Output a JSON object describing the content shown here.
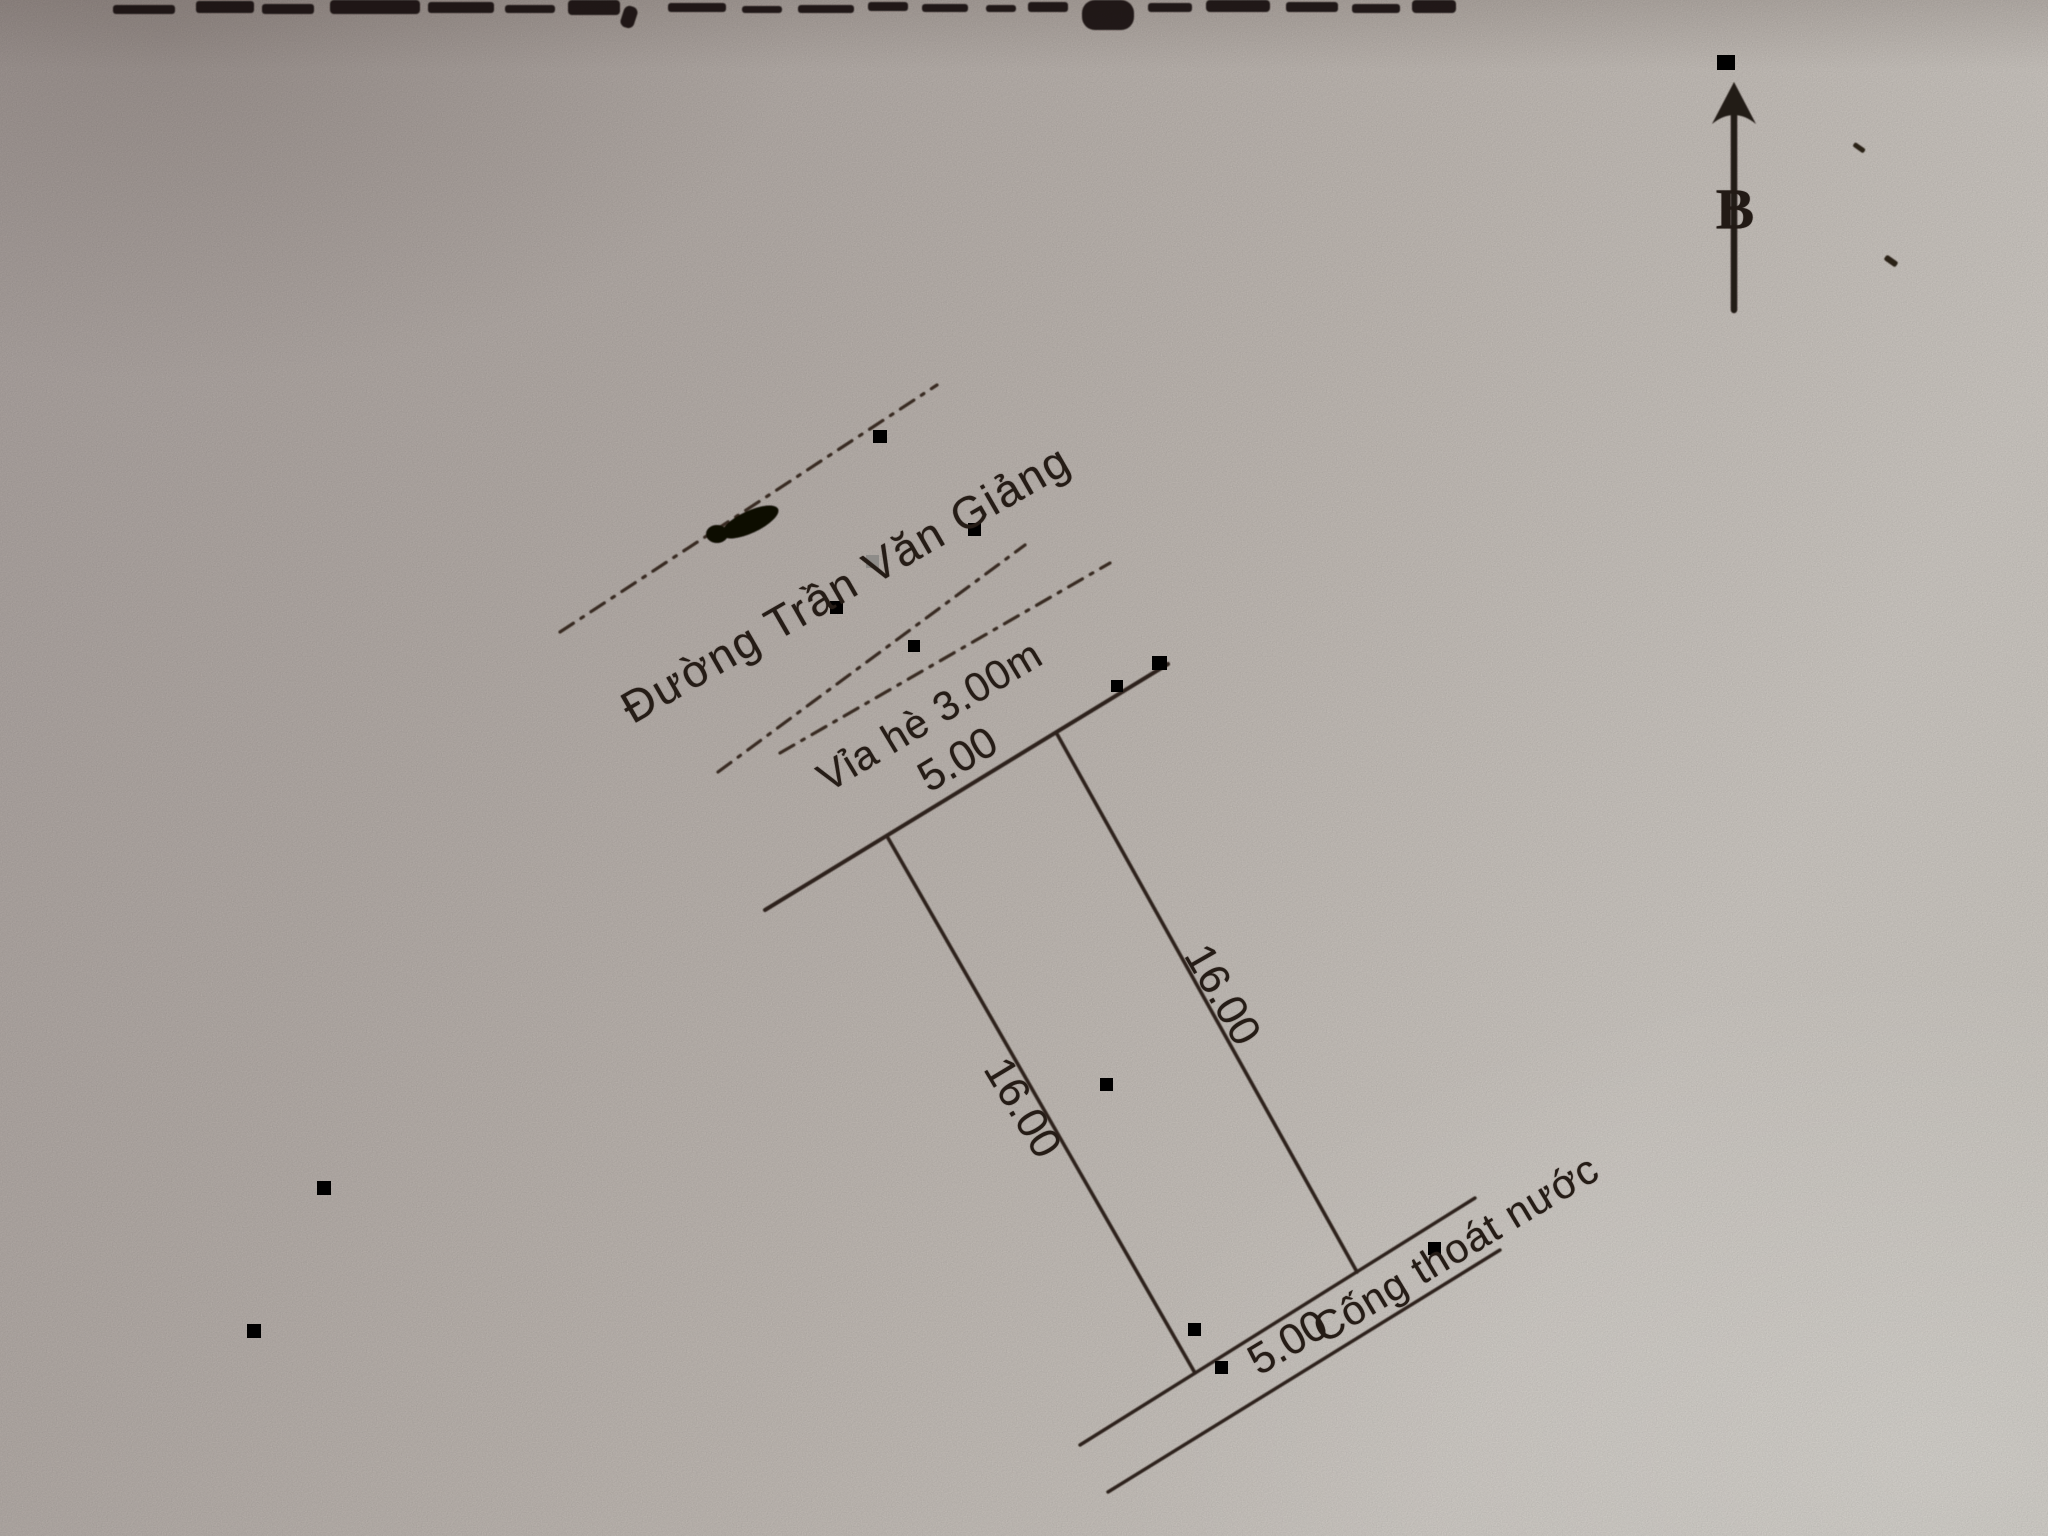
{
  "compass": {
    "north_label": "B"
  },
  "labels": {
    "street_name": "Đường Trần Văn Giảng",
    "sidewalk": "Vỉa hè 3.00m",
    "front_width": "5.00",
    "left_depth": "16.00",
    "right_depth": "16.00",
    "rear_width": "5.00",
    "drainage": "Cống thoát nước"
  },
  "colors": {
    "paper_dark": "#b1a8a5",
    "paper_light": "#d6d1cb",
    "ink": "#251c16",
    "line": "#2d241d",
    "artifact_black": "#000000"
  }
}
